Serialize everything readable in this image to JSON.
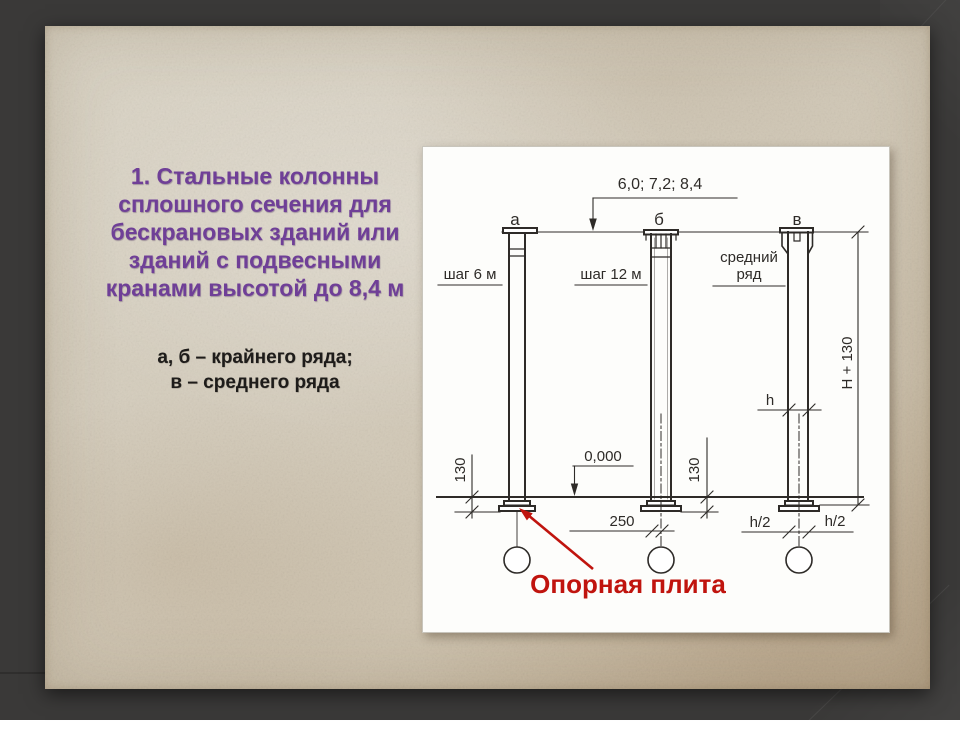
{
  "slide": {
    "background_color": "#3a3938",
    "paper_color": "#d5cdbc",
    "title": {
      "color": "#6f3f97",
      "lines": [
        "1. Стальные колонны",
        "сплошного сечения для",
        "бескрановых зданий или",
        "зданий с подвесными",
        "кранами высотой до 8,4 м"
      ]
    },
    "subtitle": {
      "color": "#1e1c1a",
      "lines": [
        "а, б – крайнего ряда;",
        "в – среднего ряда"
      ]
    }
  },
  "figure": {
    "ink_color": "#2e2b28",
    "callout_color": "#c0140e",
    "span_dim": "6,0; 7,2; 8,4",
    "column_labels": [
      "а",
      "б",
      "в"
    ],
    "step_left": "шаг 6 м",
    "step_middle": "шаг 12 м",
    "row_label_line1": "средний",
    "row_label_line2": "ряд",
    "height_dim": "Н + 130",
    "depth_label": "h",
    "level_mark": "0,000",
    "embed_left": "130",
    "embed_middle": "130",
    "offset_dim": "250",
    "half_depth_left": "h/2",
    "half_depth_right": "h/2",
    "callout": "Опорная плита"
  }
}
